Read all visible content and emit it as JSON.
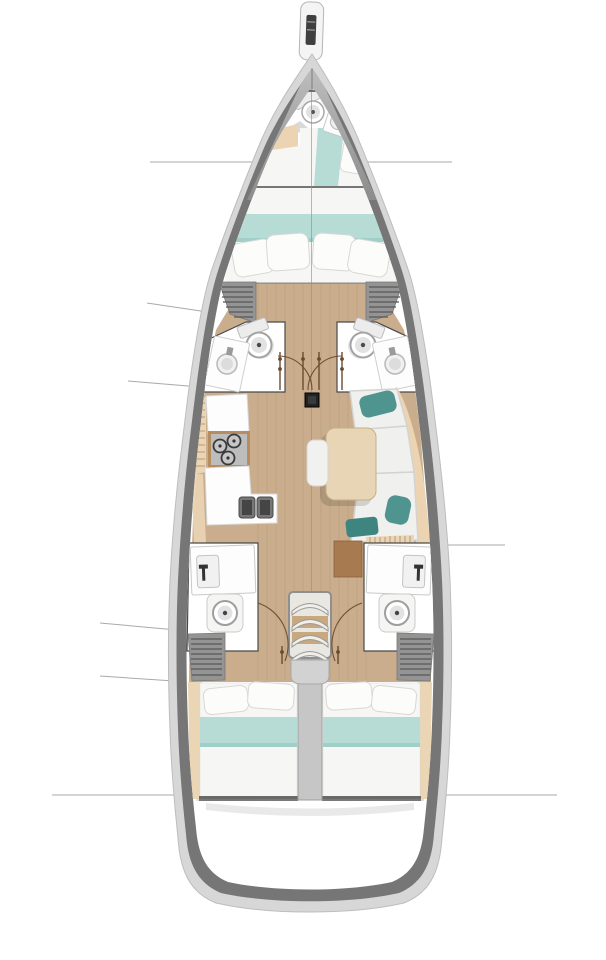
{
  "diagram": {
    "kind": "sailing-yacht-interior-deck-plan",
    "view": "top-down, bow at top, stern at bottom",
    "areas": [
      "bowsprit",
      "bow-deck",
      "forepeak-cabin",
      "forepeak-toilet",
      "forepeak-sink",
      "forepeak-berth",
      "owner-cabin-berth",
      "wardrobe-forward-port",
      "wardrobe-forward-starboard",
      "head-forward-port",
      "head-forward-starboard",
      "mast-post",
      "galley",
      "stove",
      "double-sink",
      "salon-settee",
      "salon-table",
      "head-aft-port",
      "head-aft-starboard",
      "companionway-stairs",
      "engine-compartment",
      "aft-cabin-port",
      "aft-cabin-starboard",
      "stern-area",
      "callout-lines"
    ]
  },
  "colors": {
    "background": "#ffffff",
    "hull_outer": "#d7d7d7",
    "hull_wall": "#767676",
    "interior": "#ffffff",
    "deck_top": "#c0c0c0",
    "deck_bottom": "#8c8c8c",
    "floor_wood": "#c9ad8c",
    "wall_line": "#4a4a4a",
    "bed_white": "#f6f6f4",
    "blanket_teal": "#b7dcd6",
    "blanket_teal_dark": "#9fcfc8",
    "pillow_white": "#fcfcfb",
    "pillow_edge": "#d8d8d4",
    "accent_teal": "#4f948e",
    "accent_teal_dark": "#3f857f",
    "headboard_tan": "#ecd4b2",
    "table_tan": "#e8d5b5",
    "table_edge": "#c9ae85",
    "cabinet_brown": "#a87a50",
    "locker_gray": "#949494",
    "locker_stripe": "#5a5a5a",
    "fixture_white": "#fdfdfd",
    "fixture_edge": "#c6c6c6",
    "fixture_inner": "#e2e2e2",
    "sink_dark": "#5a5a5a",
    "stove_gray": "#bdbdbd",
    "burner_dark": "#3a3a3a",
    "engine_gray": "#c6c6c6",
    "landing_gray": "#d2d2d2",
    "step_tan": "#c8a87e",
    "door_brown": "#6b4a2e",
    "callout": "#a0a0a0",
    "mast_black": "#222222",
    "liner_tan": "#ead5b5",
    "slat_line": "#b08c60"
  }
}
